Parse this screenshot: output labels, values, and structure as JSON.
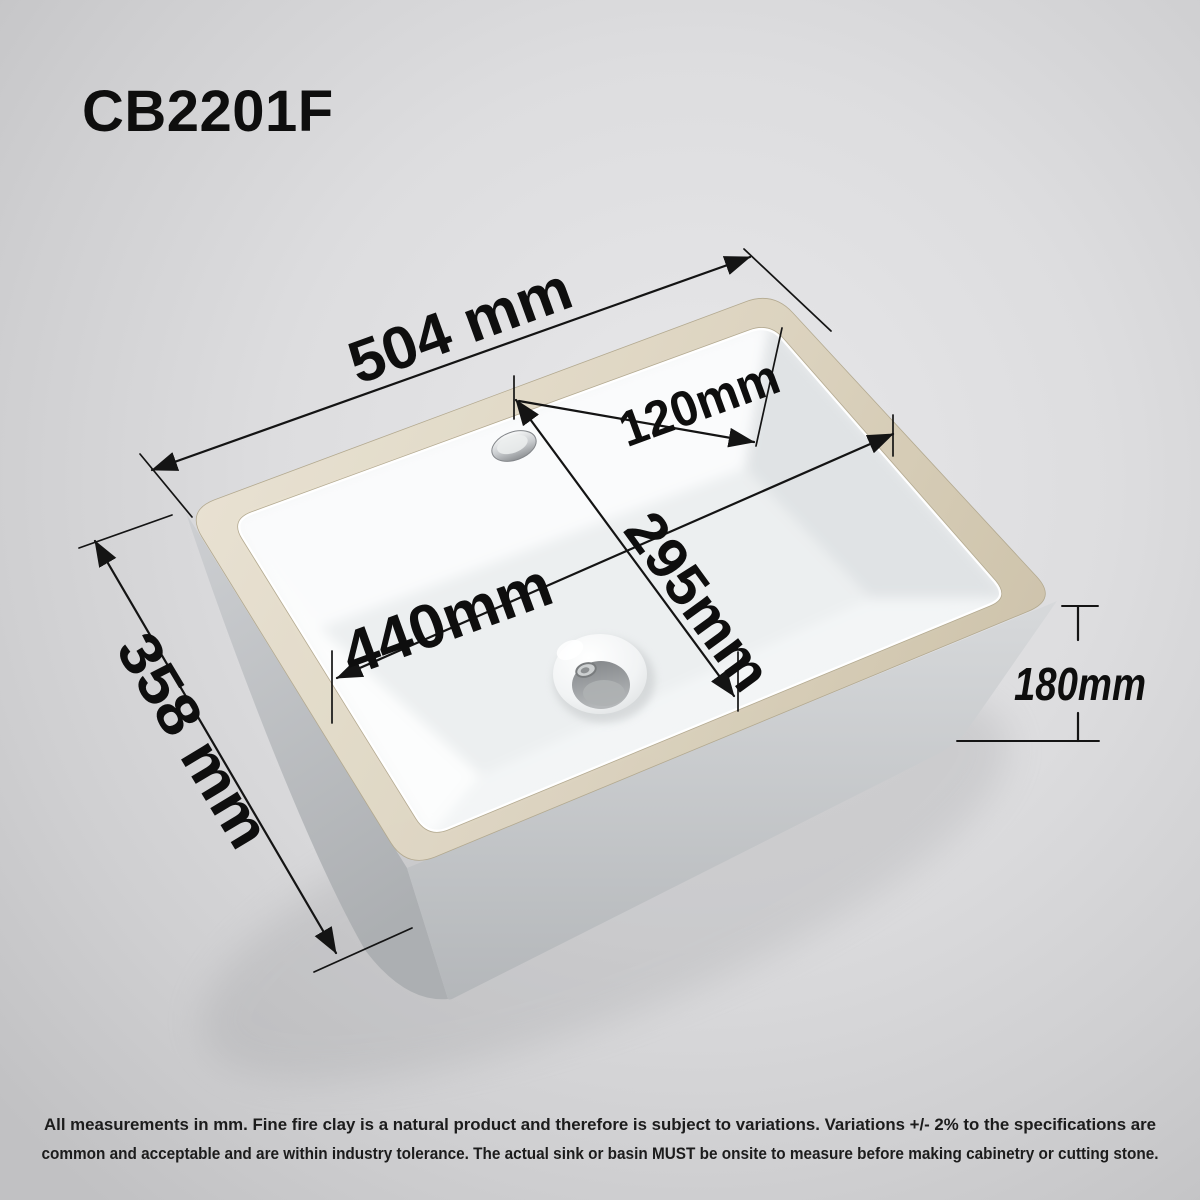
{
  "title": "CB2201F",
  "dimensions": {
    "top_length": "504 mm",
    "side_width": "358 mm",
    "inner_length": "440mm",
    "inner_width": "295mm",
    "corner_distance": "120mm",
    "depth": "180mm"
  },
  "disclaimer": {
    "line1": "All measurements in mm. Fine fire clay is a natural product and therefore is subject to variations. Variations +/- 2% to the specifications are",
    "line2": "common and acceptable and are within industry tolerance. The actual sink or basin MUST be onsite to measure before making cabinetry or cutting stone."
  },
  "colors": {
    "background": "#d7d7d9",
    "rim_clay": "#dcd3bf",
    "body_ceramic": "#c6c9cb",
    "basin_white": "#f2f4f5",
    "dimension_line": "#141414",
    "label_text": "#0e0e0e"
  }
}
